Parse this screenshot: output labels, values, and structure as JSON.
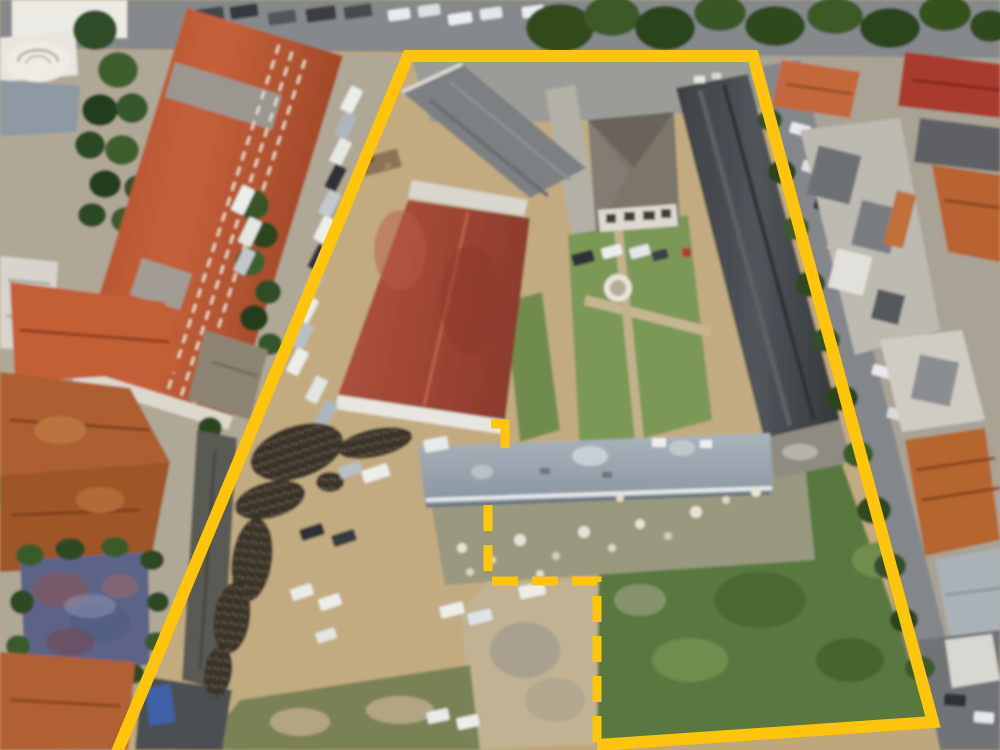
{
  "image": {
    "kind": "aerial-drone-photo",
    "subject": "land plot with buildings outlined by yellow surveyed boundary",
    "width_px": 1000,
    "height_px": 750
  },
  "colors": {
    "boundary-yellow": "#ffc50a",
    "dirt": "#bfa77c",
    "grass": "#6f8c4e",
    "dark-grass": "#587840",
    "road": "#85898b",
    "red-roof": "#bf5a33",
    "warehouse-red": "#a34635",
    "dark-roof": "#46494c",
    "silver-roof": "#9aa6b0"
  },
  "boundary": {
    "solid_points": "117,752 408,56 753,56 933,722 597,745",
    "dashed_points": "488,505 488,581 597,581 597,744",
    "stub_path": "M491,424 L505,424 L505,448",
    "dash_pattern": "26 14",
    "solid_width": "12",
    "dashed_width": "9"
  }
}
